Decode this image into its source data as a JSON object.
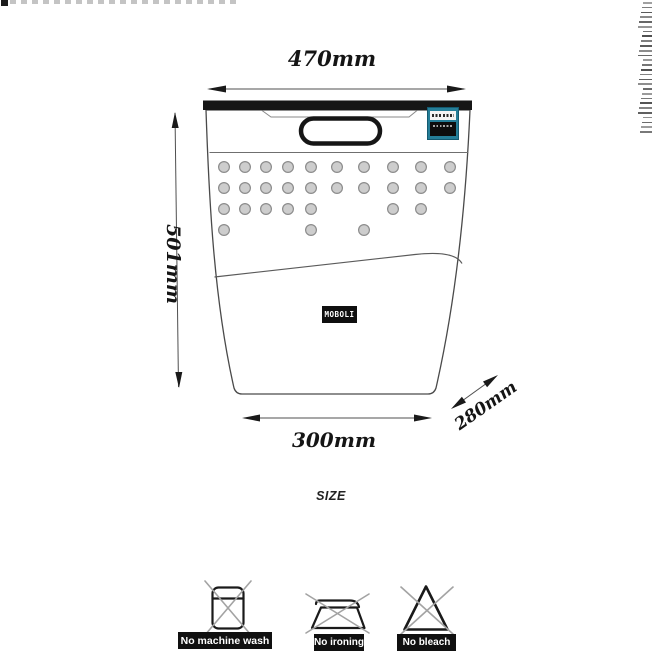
{
  "diagram": {
    "title": "SIZE",
    "brand_label": "MOBOLI",
    "dimensions": {
      "top_width": "470mm",
      "height": "501mm",
      "bottom_width": "300mm",
      "depth": "280mm"
    },
    "vent_holes": {
      "radius": 5.4,
      "rows": [
        {
          "y": 167,
          "xs": [
            224,
            245,
            266,
            288,
            311,
            337,
            364,
            393,
            421,
            450
          ]
        },
        {
          "y": 188,
          "xs": [
            224,
            245,
            266,
            288,
            311,
            337,
            364,
            393,
            421,
            450
          ]
        },
        {
          "y": 209,
          "xs": [
            224,
            245,
            266,
            288,
            311,
            393,
            421
          ]
        },
        {
          "y": 230,
          "xs": [
            224,
            311,
            364
          ]
        }
      ]
    },
    "tag_color": "#257e98"
  },
  "care_instructions": {
    "items": [
      {
        "icon": "no-machine-wash-icon",
        "label": "No machine wash"
      },
      {
        "icon": "no-ironing-icon",
        "label": "No ironing"
      },
      {
        "icon": "no-bleach-icon",
        "label": "No bleach"
      }
    ]
  },
  "artifacts": {
    "right_edge_mark_count": 28
  },
  "colors": {
    "ink": "#1a1a1a",
    "rim": "#161616",
    "dot_fill": "#cdcdcd",
    "dot_stroke": "#8d8d8d",
    "cross_grey": "#a3a3a3",
    "label_bg": "#101010",
    "label_text": "#ffffff",
    "tag_teal": "#257e98"
  }
}
